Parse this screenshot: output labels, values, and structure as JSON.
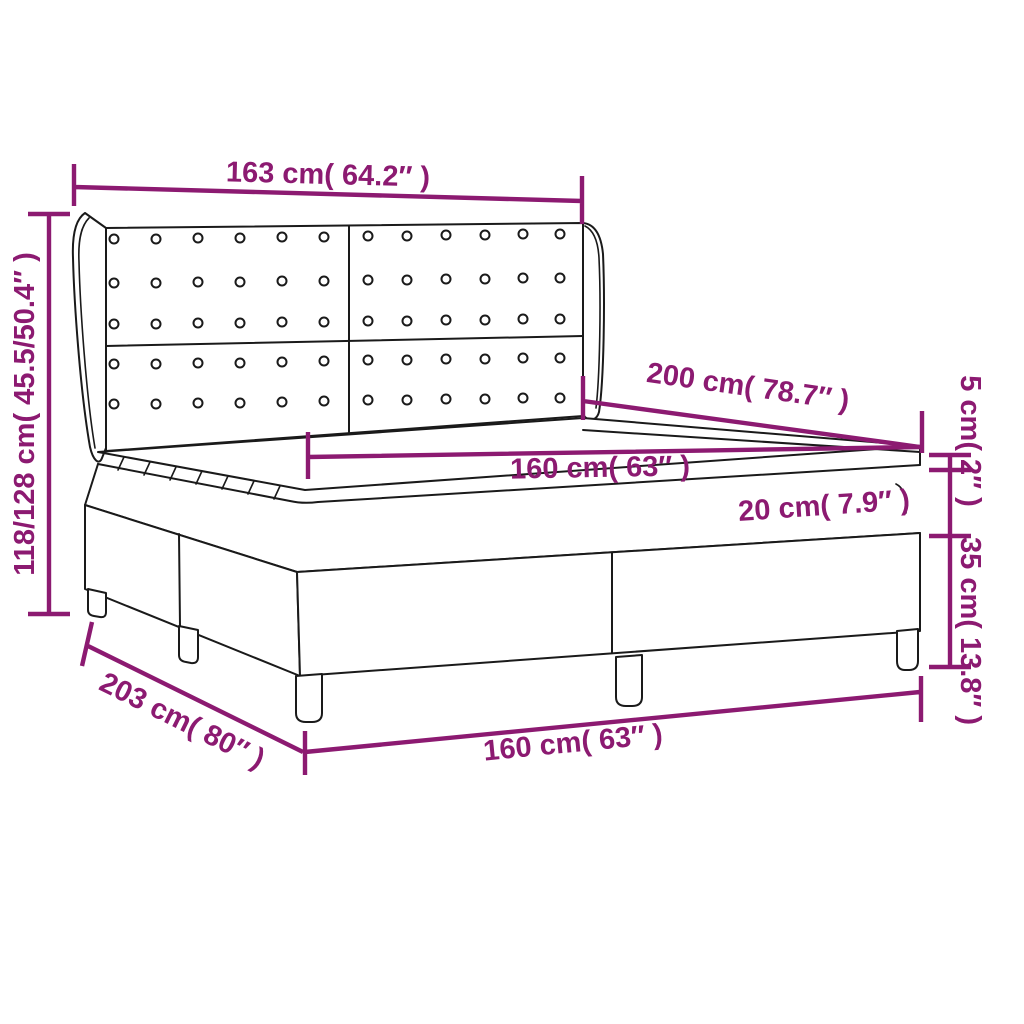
{
  "page": {
    "background": "#ffffff"
  },
  "diagram": {
    "type": "product-dimension-diagram",
    "subject": "box spring bed with tufted wingback headboard, mattress and topper",
    "accent_color": "#8C1A71",
    "outline_color": "#1a1a1a",
    "labels": {
      "headboard_width": "163 cm( 64.2″ )",
      "overall_height": "118/128 cm( 45.5/50.4″ )",
      "length_top": "200 cm( 78.7″ )",
      "width_mattress": "160 cm( 63″ )",
      "mattress_thickness": "20 cm( 7.9″ )",
      "topper_thickness": "5 cm( 2″ )",
      "base_height": "35 cm( 13.8″ )",
      "length_base": "203 cm( 80″ )",
      "width_base": "160 cm( 63″ )"
    }
  }
}
